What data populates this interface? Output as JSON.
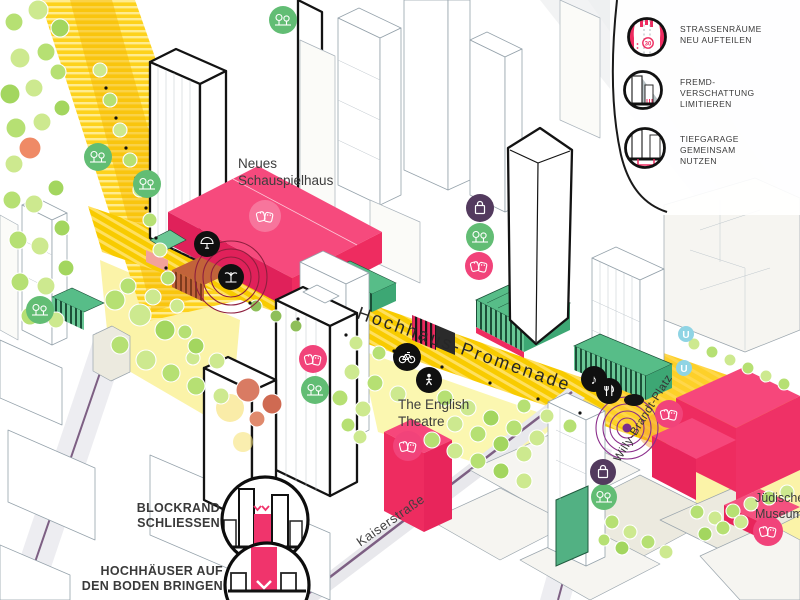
{
  "legend": {
    "items": [
      {
        "icon": "tempo-30-street-redistribution-icon",
        "tempo": "30",
        "lines": [
          "STRASSENRÄUME",
          "NEU AUFTEILEN"
        ]
      },
      {
        "icon": "building-shadow-icon",
        "lines": [
          "FREMD-",
          "VERSCHATTUNG",
          "LIMITIEREN"
        ]
      },
      {
        "icon": "underground-garage-icon",
        "lines": [
          "TIEFGARAGE",
          "GEMEINSAM",
          "NUTZEN"
        ]
      }
    ]
  },
  "annotations": {
    "blockrand": {
      "icon": "blockrand-close-icon",
      "lines": [
        "BLOCKRAND",
        "SCHLIESSEN"
      ]
    },
    "hochhaeuser": {
      "icon": "tower-to-ground-icon",
      "lines": [
        "HOCHHÄUSER AUF",
        "DEN BODEN BRINGEN"
      ]
    }
  },
  "map": {
    "labels": {
      "neues_schauspielhaus": {
        "lines": [
          "Neues",
          "Schauspielhaus"
        ]
      },
      "hochhaus_promenade": "Hochhaus-Promenade",
      "the_english_theatre": {
        "lines": [
          "The English",
          "Theatre"
        ]
      },
      "kaiserstrasse": "Kaiserstraße",
      "willy_brandt_platz": "Willy-Brandt-Platz",
      "juedisches_museum": {
        "lines": [
          "Jüdisches",
          "Museum"
        ]
      }
    },
    "markers": {
      "u_bahn": "U",
      "music_note": "♪"
    },
    "badges": [
      {
        "icon": "trees-icon",
        "meaning": "greenery / planting",
        "color": "#62bd74"
      },
      {
        "icon": "theatre-masks-icon",
        "meaning": "culture / theatre",
        "color": "#f1437a"
      },
      {
        "icon": "shopping-bag-icon",
        "meaning": "retail",
        "color": "#533a5e"
      },
      {
        "icon": "bicycle-icon",
        "meaning": "cycling",
        "color": "#111111"
      },
      {
        "icon": "pedestrian-icon",
        "meaning": "walking",
        "color": "#111111"
      },
      {
        "icon": "music-icon",
        "meaning": "music venue",
        "color": "#111111"
      },
      {
        "icon": "dining-icon",
        "meaning": "gastronomy",
        "color": "#111111"
      },
      {
        "icon": "fountain-icon",
        "meaning": "fountain / plaza",
        "color": "#111111"
      },
      {
        "icon": "pavilion-icon",
        "meaning": "pavilion / kiosk",
        "color": "#111111"
      },
      {
        "icon": "u-bahn-icon",
        "meaning": "metro entrance",
        "color": "#8fd4e4"
      }
    ],
    "colors": {
      "pink_building": "#ee2c60",
      "promenade_yellow": "#f8cb00",
      "light_yellow": "#fbf3a8",
      "podium_green": "#57bd88",
      "tree_green": "#b6e073",
      "orange_overlay": "#f59b2e",
      "ring_red": "#8e1f3e",
      "ring_purple": "#8b2d8b",
      "street_purple": "#7d5f83"
    }
  }
}
